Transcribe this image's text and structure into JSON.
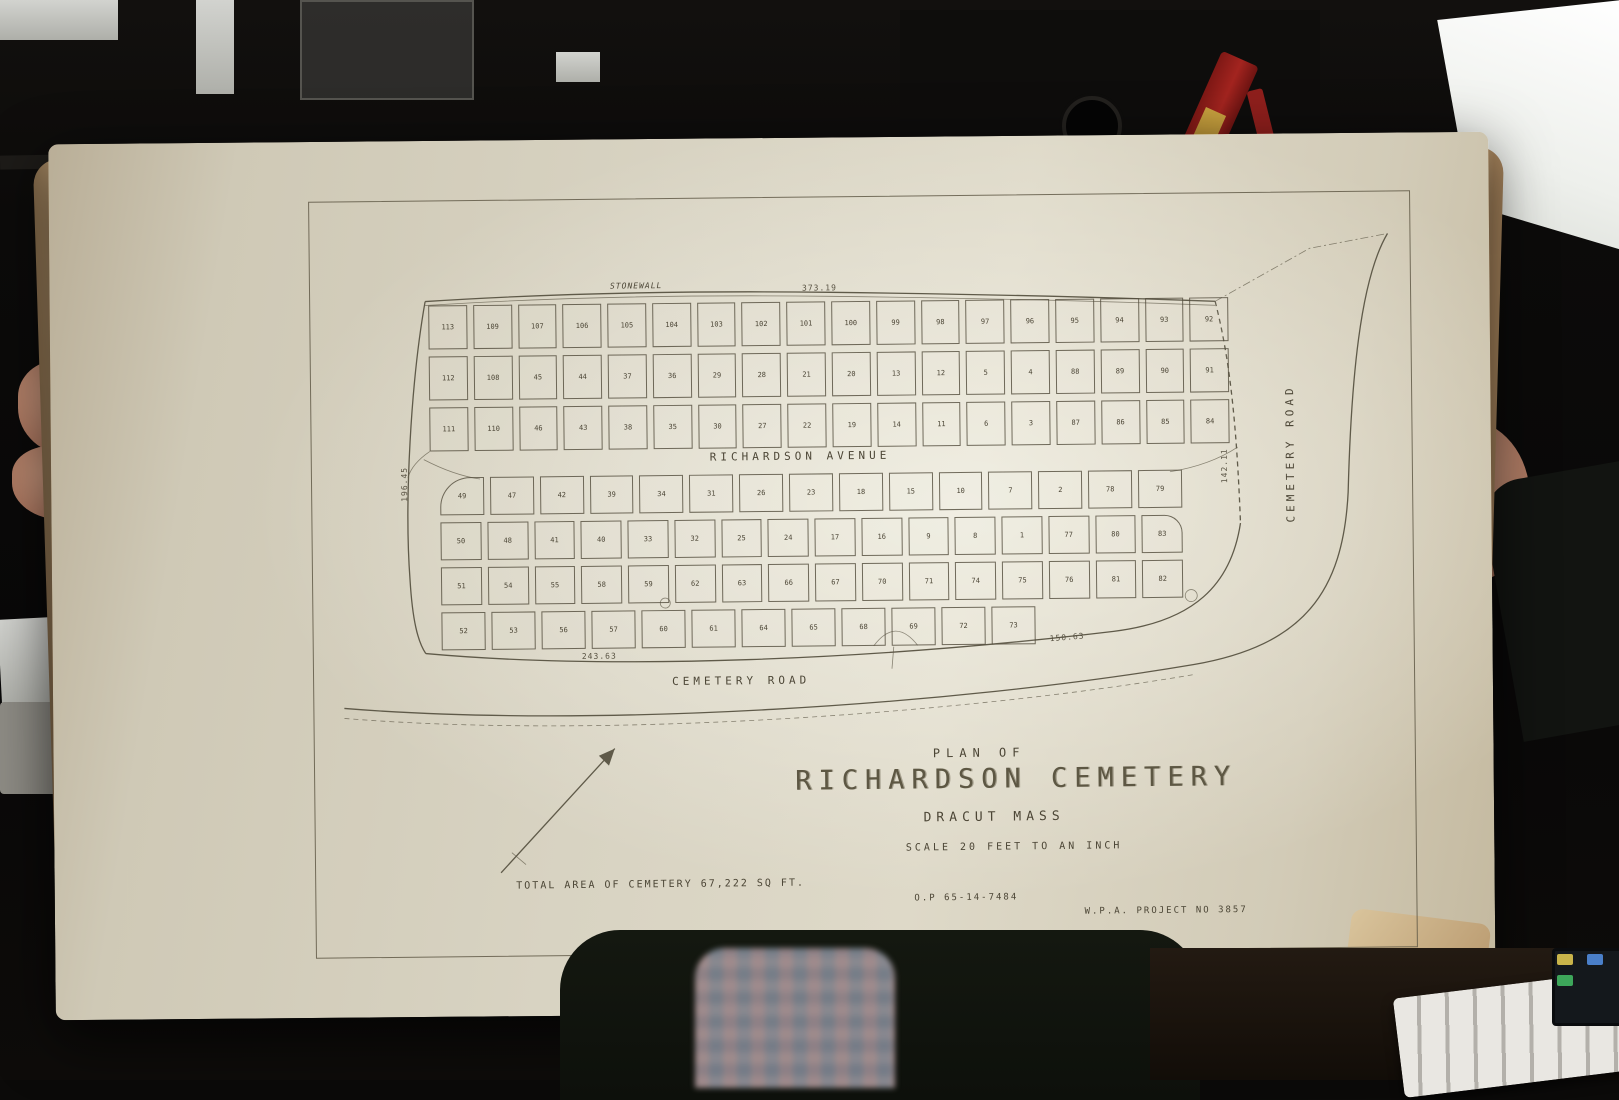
{
  "plan": {
    "title_block": {
      "plan_of": "PLAN OF",
      "name": "RICHARDSON CEMETERY",
      "place": "DRACUT MASS",
      "scale": "SCALE 20 FEET TO AN INCH"
    },
    "footer": {
      "total_area": "TOTAL AREA OF CEMETERY 67,222 SQ FT.",
      "op_number": "O.P 65-14-7484",
      "wpa_project": "W.P.A. PROJECT NO 3857"
    },
    "labels": {
      "stonewall": "STONEWALL",
      "avenue": "RICHARDSON AVENUE",
      "road_bottom": "CEMETERY ROAD",
      "road_right": "CEMETERY ROAD"
    },
    "dimensions": {
      "top": "373.19",
      "bottom": "243.63",
      "bottom_right": "150.63",
      "right": "142.11",
      "left": "196.45"
    },
    "upper_block": {
      "rows": [
        [
          "113",
          "109",
          "107",
          "106",
          "105",
          "104",
          "103",
          "102",
          "101",
          "100",
          "99",
          "98",
          "97",
          "96",
          "95",
          "94",
          "93",
          "92"
        ],
        [
          "112",
          "108",
          "45",
          "44",
          "37",
          "36",
          "29",
          "28",
          "21",
          "20",
          "13",
          "12",
          "5",
          "4",
          "88",
          "89",
          "90",
          "91"
        ],
        [
          "111",
          "110",
          "46",
          "43",
          "38",
          "35",
          "30",
          "27",
          "22",
          "19",
          "14",
          "11",
          "6",
          "3",
          "87",
          "86",
          "85",
          "84"
        ]
      ]
    },
    "lower_block": {
      "rows": [
        [
          "49",
          "47",
          "42",
          "39",
          "34",
          "31",
          "26",
          "23",
          "18",
          "15",
          "10",
          "7",
          "2",
          "78",
          "79"
        ],
        [
          "50",
          "48",
          "41",
          "40",
          "33",
          "32",
          "25",
          "24",
          "17",
          "16",
          "9",
          "8",
          "1",
          "77",
          "80",
          "83"
        ],
        [
          "51",
          "54",
          "55",
          "58",
          "59",
          "62",
          "63",
          "66",
          "67",
          "70",
          "71",
          "74",
          "75",
          "76",
          "81",
          "82"
        ],
        [
          "52",
          "53",
          "56",
          "57",
          "60",
          "61",
          "64",
          "65",
          "68",
          "69",
          "72",
          "73"
        ]
      ]
    }
  },
  "colors": {
    "paper": "#d8d3c2",
    "ink": "#4c4636",
    "background": "#0b0a09",
    "skin": "#a9735c",
    "red_tool": "#a3241f",
    "softbox": "#f5f4ef"
  }
}
